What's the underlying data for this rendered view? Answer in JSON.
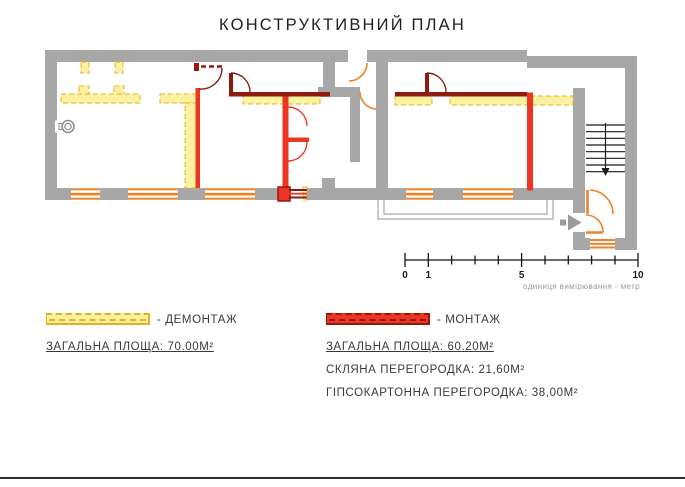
{
  "title": "КОНСТРУКТИВНИЙ ПЛАН",
  "plan": {
    "colors": {
      "wall_gray": "#A7A7A7",
      "demolition_yellow": "#FBF2A0",
      "demolition_border": "#E9AE26",
      "installation_red": "#EE3524",
      "installation_dark": "#8E1A10",
      "door_orange": "#F08228",
      "stairs_black": "#1A1A1A"
    }
  },
  "scale_bar": {
    "tick_labels": [
      "0",
      "1",
      "5",
      "10"
    ],
    "caption": "одиниця вимірювання - метр"
  },
  "legend": {
    "demolition": {
      "label": "- ДЕМОНТАЖ",
      "total_area": "ЗАГАЛЬНА ПЛОЩА: 70.00М²"
    },
    "installation": {
      "label": "- МОНТАЖ",
      "total_area": "ЗАГАЛЬНА ПЛОЩА: 60.20М²",
      "glass_partition": "СКЛЯНА ПЕРЕГОРОДКА: 21,60М²",
      "drywall_partition": "ГІПСОКАРТОННА ПЕРЕГОРОДКА: 38,00М²"
    }
  }
}
